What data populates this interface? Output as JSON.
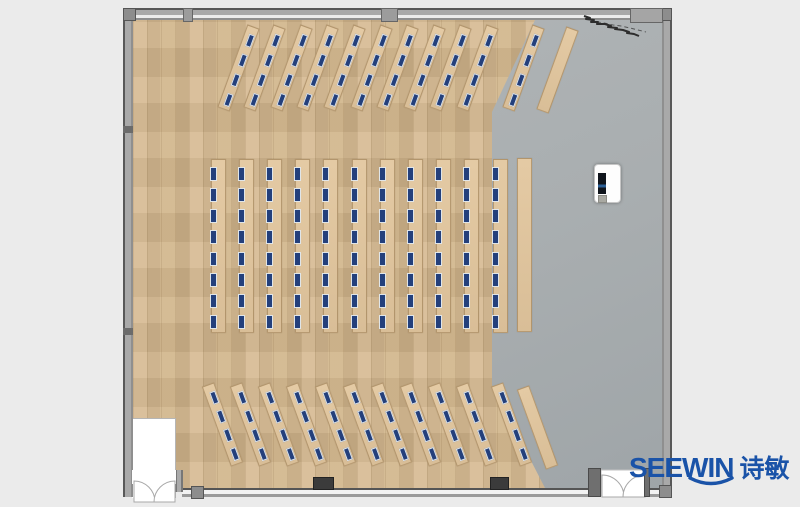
{
  "brand": {
    "logo_text": "SEEWIN",
    "logo_text_cn": "诗敏"
  },
  "palette": {
    "background": "#ebebeb",
    "wood_floor": "#d0b58d",
    "gray_floor": "#a9aeb0",
    "wall_fill": "#a2a2a2",
    "wall_edge": "#565656",
    "desk_top": "#d9be97",
    "seat_marker": "#24407c",
    "logo_blue": "#1a53a8"
  },
  "room": {
    "x": 123,
    "y": 8,
    "width": 549,
    "height": 489,
    "wall_thickness": 10
  },
  "floors": {
    "gray_region_polygon": [
      [
        402,
        0
      ],
      [
        529,
        0
      ],
      [
        529,
        468
      ],
      [
        412,
        468
      ],
      [
        359,
        365
      ],
      [
        359,
        92
      ]
    ]
  },
  "furniture": {
    "blocks": [
      {
        "id": "front-angled-rows",
        "angle": 20,
        "count": 10,
        "x0": 238,
        "dx": 26.6,
        "y0": 68,
        "strip_w": 13,
        "strip_l": 88,
        "seats": 4,
        "seat_w": 4,
        "seat_h": 11,
        "seat_align": "center",
        "extra": [
          {
            "cx": 523,
            "cy": 68
          },
          {
            "cx": 557,
            "cy": 70,
            "plain": true
          }
        ]
      },
      {
        "id": "center-columns",
        "angle": 0,
        "count": 11,
        "x0": 218,
        "dx": 28.2,
        "y0": 246,
        "strip_w": 15,
        "strip_l": 174,
        "seats": 8,
        "seat_w": 5,
        "seat_h": 12,
        "seat_align": "left",
        "extra": [
          {
            "cx": 524,
            "cy": 245,
            "plain": true
          }
        ]
      },
      {
        "id": "rear-angled-rows",
        "angle": -20,
        "count": 10,
        "x0": 222,
        "dx": 28.3,
        "y0": 424,
        "strip_w": 13,
        "strip_l": 85,
        "seats": 4,
        "seat_w": 4,
        "seat_h": 11,
        "seat_align": "center",
        "extra": [
          {
            "cx": 511,
            "cy": 424
          },
          {
            "cx": 537,
            "cy": 427,
            "plain": true
          }
        ]
      }
    ],
    "seat_counts": {
      "front_block": 44,
      "center_block": 88,
      "rear_block": 44,
      "total": 176
    },
    "lectern": {
      "x": 594,
      "y": 164,
      "width": 27,
      "height": 39
    }
  },
  "doors": [
    {
      "id": "entrance-bottom-left",
      "x": 131,
      "y": 470,
      "width": 45,
      "type": "double-swing"
    },
    {
      "id": "entrance-bottom-right",
      "x": 601,
      "y": 470,
      "width": 47,
      "type": "double-swing"
    }
  ],
  "decor": {
    "top_right_wall_sketch": true
  }
}
